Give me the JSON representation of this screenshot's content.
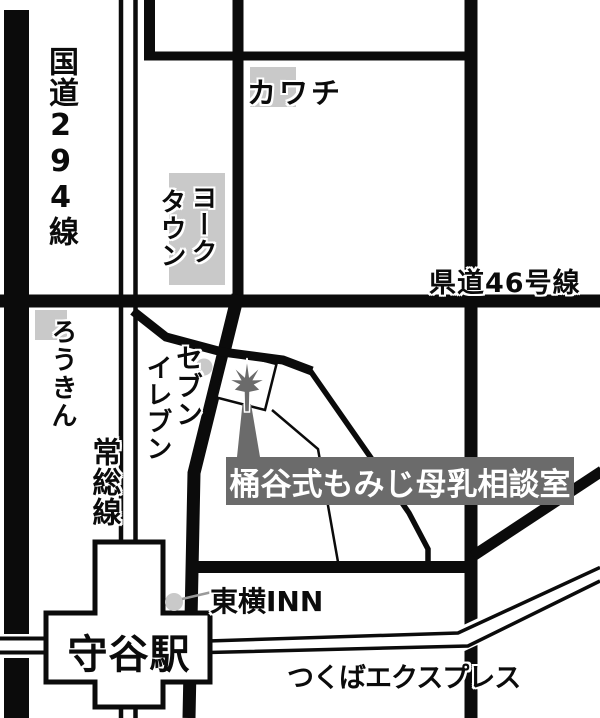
{
  "palette": {
    "background": "#ffffff",
    "road_black": "#0b0b0b",
    "light_gray": "#c9c9c9",
    "dark_gray": "#6b6b6b",
    "leader_gray": "#9a9a9a",
    "label_text": "#0b0b0b",
    "destination_text": "#ffffff"
  },
  "roads": {
    "route_294": "国道294線",
    "prefectural_46": "県道46号線"
  },
  "railways": {
    "joso_line": "常総線",
    "tsukuba_express": "つくばエクスプレス"
  },
  "station": {
    "moriya": "守谷駅"
  },
  "landmarks": {
    "kawachi": "カワチ",
    "york_town": {
      "col_right": "ヨーク",
      "col_left": "タウン"
    },
    "rokin": "ろうきん",
    "seven_eleven": {
      "col_right": "セブン",
      "col_left": "イレブン"
    },
    "toyoko_inn": "東横INN"
  },
  "destination": {
    "name": "桶谷式もみじ母乳相談室",
    "marker": "maple-leaf-icon"
  }
}
